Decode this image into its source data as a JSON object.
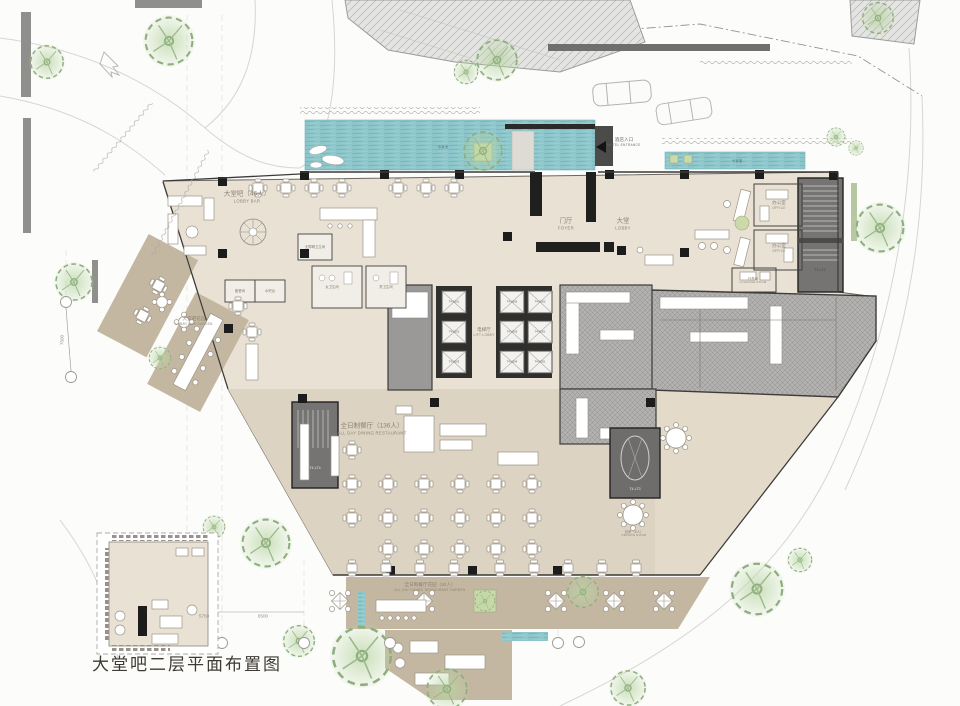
{
  "title": "大堂吧二层平面布置图",
  "colors": {
    "water": "#8dc6ca",
    "floor": "#e9e1d4",
    "restaurant_floor": "#ddd3c2",
    "deck": "#c4b7a1",
    "boh_hatch": "#b3b1b0",
    "stair_block": "#757473",
    "wall": "#1c1c1c",
    "tree": "#b9d6a3"
  },
  "rooms": {
    "lobby_bar": {
      "zh": "大堂吧（46人）",
      "en": "LOBBY BAR"
    },
    "foyer": {
      "zh": "门厅",
      "en": "FOYER"
    },
    "lobby": {
      "zh": "大堂",
      "en": "LOBBY"
    },
    "lift_lobby": {
      "zh": "电梯厅",
      "en": "LIFT LOBBY"
    },
    "office": {
      "zh": "办公室",
      "en": "OFFICE"
    },
    "luggage": {
      "zh": "行李间",
      "en": "LUGGAGE ROOM"
    },
    "restaurant": {
      "zh": "全日制餐厅（136人）",
      "en": "ALL DAY DINING RESTAURANT"
    },
    "restaurant_garden": {
      "zh": "全日制餐厅花园（52人）",
      "en": "ALL DAY DINING RESTAURANT GARDEN"
    },
    "lobby_bar_garden": {
      "zh": "大堂吧花园",
      "en": "LOBBY BAR GARDEN"
    },
    "private_dining": {
      "zh": "包房（6人）",
      "en": "PRIVATE ROOM"
    },
    "pantry": {
      "zh": "备餐间"
    },
    "water_bar": {
      "zh": "水吧台"
    },
    "acc_toilet": {
      "zh": "无障碍卫生间"
    },
    "female_toilet": {
      "zh": "女卫生间"
    },
    "male_toilet": {
      "zh": "男卫生间"
    }
  },
  "site": {
    "hotel_entrance": {
      "zh": "酒店入口",
      "en": "HOTEL ENTRANCE"
    },
    "water_pool": {
      "zh": "水景池"
    },
    "water_wall": {
      "zh": "水景墙"
    }
  },
  "cores": {
    "stairs": [
      "T4-LT2",
      "T4-LT3",
      "T4-LT4"
    ],
    "lifts_left": [
      "T4-LD01",
      "T4-LD02",
      "T4-LD03"
    ],
    "lifts_mid": [
      "T4-LD06",
      "T4-LD05",
      "T4-LD04"
    ],
    "lifts_right": [
      "T4-KD02",
      "T4-KD01",
      "T4-KD01"
    ]
  },
  "dims": [
    "5750",
    "8500",
    "7500"
  ]
}
